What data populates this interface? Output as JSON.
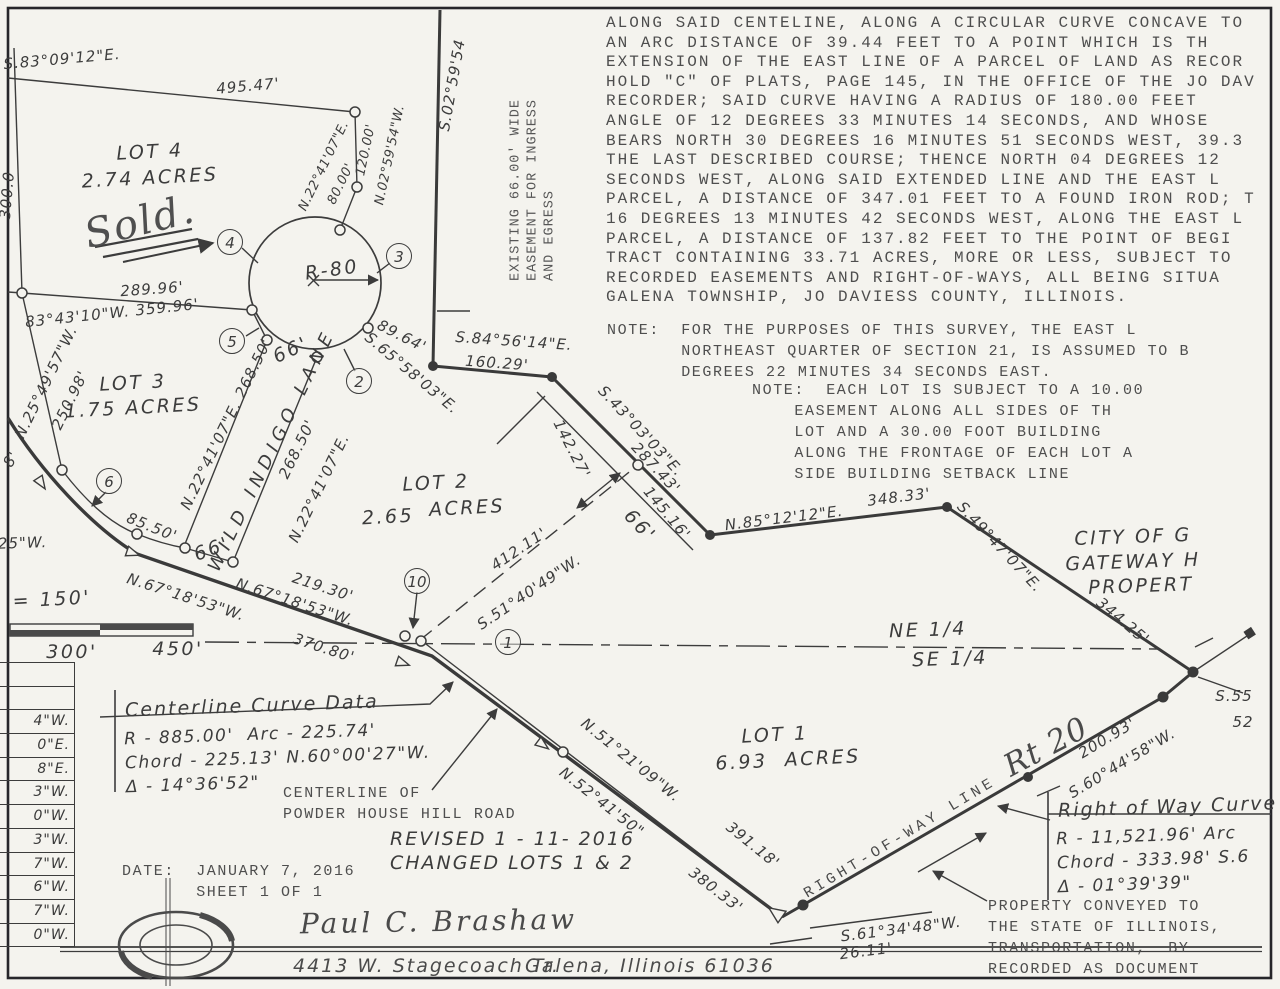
{
  "legal_description": "ALONG SAID CENTELINE, ALONG A CIRCULAR CURVE CONCAVE TO\nAN ARC DISTANCE OF 39.44 FEET TO A POINT WHICH IS TH\nEXTENSION OF THE EAST LINE OF A PARCEL OF LAND AS RECOR\nHOLD \"C\" OF PLATS, PAGE 145, IN THE OFFICE OF THE JO DAV\nRECORDER; SAID CURVE HAVING A RADIUS OF 180.00 FEET\nANGLE OF 12 DEGREES 33 MINUTES 14 SECONDS, AND WHOSE\nBEARS NORTH 30 DEGREES 16 MINUTES 51 SECONDS WEST, 39.3\nTHE LAST DESCRIBED COURSE; THENCE NORTH 04 DEGREES 12\nSECONDS WEST, ALONG SAID EXTENDED LINE AND THE EAST L\nPARCEL, A DISTANCE OF 347.01 FEET TO A FOUND IRON ROD; T\n16 DEGREES 13 MINUTES 42 SECONDS WEST, ALONG THE EAST L\nPARCEL, A DISTANCE OF 137.82 FEET TO THE POINT OF BEGI\nTRACT CONTAINING 33.71 ACRES, MORE OR LESS, SUBJECT TO\nRECORDED EASEMENTS AND RIGHT-OF-WAYS, ALL BEING SITUA\nGALENA TOWNSHIP, JO DAVIESS COUNTY, ILLINOIS.",
  "note_survey": "NOTE:  FOR THE PURPOSES OF THIS SURVEY, THE EAST L\n       NORTHEAST QUARTER OF SECTION 21, IS ASSUMED TO B\n       DEGREES 22 MINUTES 34 SECONDS EAST.",
  "note_lot": "NOTE:  EACH LOT IS SUBJECT TO A 10.00\n    EASEMENT ALONG ALL SIDES OF TH\n    LOT AND A 30.00 FOOT BUILDING\n    ALONG THE FRONTAGE OF EACH LOT A\n    SIDE BUILDING SETBACK LINE",
  "centerline_curve": {
    "title": "Centerline Curve Data",
    "body": "R - 885.00'  Arc - 225.74'\nChord - 225.13' N.60°00'27\"W.\nΔ - 14°36'52\""
  },
  "row_curve": {
    "title": "Right of Way Curve",
    "body": "R - 11,521.96' Arc\nChord - 333.98' S.6\nΔ - 01°39'39\""
  },
  "property_note": "PROPERTY CONVEYED TO\nTHE STATE OF ILLINOIS,\nTRANSPORTATION,  BY\nRECORDED AS DOCUMENT",
  "centerline_of": "CENTERLINE OF\nPOWDER HOUSE HILL ROAD",
  "revision": "REVISED 1 - 11- 2016\nCHANGED LOTS 1 & 2",
  "dateblock": "DATE:  JANUARY 7, 2016\n       SHEET 1 OF 1",
  "footer": {
    "name": "Paul C. Brashaw",
    "address": "4413 W. Stagecoach Tr.",
    "city": "Galena, Illinois  61036"
  },
  "side_table": [
    "",
    "",
    "4\"W.",
    "0\"E.",
    "8\"E.",
    "3\"W.",
    "0\"W.",
    "3\"W.",
    "7\"W.",
    "6\"W.",
    "7\"W.",
    "0\"W."
  ],
  "labels": [
    {
      "t": "S.83°09'12\"E.",
      "x": 62,
      "y": 59,
      "r": -5,
      "c": "hand"
    },
    {
      "t": "495.47'",
      "x": 248,
      "y": 86,
      "r": -5,
      "c": "hand"
    },
    {
      "t": "N.22°41'07\"E.",
      "x": 324,
      "y": 166,
      "r": -64,
      "c": "hand-s"
    },
    {
      "t": "80.00'",
      "x": 341,
      "y": 184,
      "r": -64,
      "c": "hand-s"
    },
    {
      "t": "120.00'",
      "x": 366,
      "y": 150,
      "r": -78,
      "c": "hand-s"
    },
    {
      "t": "N.02°59'54\"W.",
      "x": 390,
      "y": 155,
      "r": -78,
      "c": "hand-s"
    },
    {
      "t": "S.02°59'54",
      "x": 452,
      "y": 85,
      "r": -80,
      "c": "hand"
    },
    {
      "t": "300.0",
      "x": 7,
      "y": 195,
      "r": -85,
      "c": "hand"
    },
    {
      "t": "LOT 4",
      "x": 150,
      "y": 152,
      "r": -3,
      "c": "hand-big"
    },
    {
      "t": "2.74 ACRES",
      "x": 150,
      "y": 178,
      "r": -3,
      "c": "hand-big"
    },
    {
      "t": "Sold.",
      "x": 140,
      "y": 222,
      "r": -14,
      "c": "script-big"
    },
    {
      "t": "289.96'",
      "x": 152,
      "y": 289,
      "r": -4,
      "c": "hand"
    },
    {
      "t": "83°43'10\"W. 359.96'",
      "x": 112,
      "y": 313,
      "r": -6,
      "c": "hand"
    },
    {
      "t": "N.25°49'57\"W.",
      "x": 46,
      "y": 382,
      "r": -64,
      "c": "hand"
    },
    {
      "t": "250.98'",
      "x": 70,
      "y": 400,
      "r": -64,
      "c": "hand"
    },
    {
      "t": "8'",
      "x": 11,
      "y": 459,
      "r": -60,
      "c": "hand"
    },
    {
      "t": "LOT 3",
      "x": 133,
      "y": 383,
      "r": -3,
      "c": "hand-big"
    },
    {
      "t": "1.75 ACRES",
      "x": 133,
      "y": 408,
      "r": -3,
      "c": "hand-big"
    },
    {
      "t": "N.22°41'07\"E. 268.50'",
      "x": 226,
      "y": 424,
      "r": -64,
      "c": "hand"
    },
    {
      "t": "WILD INDIGO LANE",
      "x": 272,
      "y": 450,
      "r": -64,
      "c": "hand-sp"
    },
    {
      "t": "268.50'",
      "x": 297,
      "y": 449,
      "r": -64,
      "c": "hand"
    },
    {
      "t": "N.22°41'07\"E.",
      "x": 319,
      "y": 488,
      "r": -64,
      "c": "hand"
    },
    {
      "t": "66'",
      "x": 291,
      "y": 350,
      "r": -25,
      "c": "hand-big"
    },
    {
      "t": "66'",
      "x": 212,
      "y": 549,
      "r": -20,
      "c": "hand-big"
    },
    {
      "t": "85.50'",
      "x": 152,
      "y": 527,
      "r": 22,
      "c": "hand"
    },
    {
      "t": "'25\"W.",
      "x": 20,
      "y": 543,
      "r": -2,
      "c": "hand"
    },
    {
      "t": "89.64'",
      "x": 402,
      "y": 336,
      "r": 27,
      "c": "hand"
    },
    {
      "t": "S.65°58'03\"E.",
      "x": 412,
      "y": 373,
      "r": 40,
      "c": "hand"
    },
    {
      "t": "S.84°56'14\"E.",
      "x": 514,
      "y": 341,
      "r": 4,
      "c": "hand"
    },
    {
      "t": "160.29'",
      "x": 497,
      "y": 363,
      "r": 4,
      "c": "hand"
    },
    {
      "t": "142.27'",
      "x": 572,
      "y": 449,
      "r": 63,
      "c": "hand"
    },
    {
      "t": "S.43°03'03\"E.",
      "x": 641,
      "y": 431,
      "r": 47,
      "c": "hand"
    },
    {
      "t": "287.43'",
      "x": 656,
      "y": 468,
      "r": 47,
      "c": "hand"
    },
    {
      "t": "145.16'",
      "x": 667,
      "y": 513,
      "r": 50,
      "c": "hand"
    },
    {
      "t": "66'",
      "x": 640,
      "y": 526,
      "r": 47,
      "c": "hand-big"
    },
    {
      "t": "LOT 2",
      "x": 436,
      "y": 483,
      "r": -3,
      "c": "hand-big"
    },
    {
      "t": "2.65",
      "x": 388,
      "y": 517,
      "r": -3,
      "c": "hand-big"
    },
    {
      "t": "ACRES",
      "x": 467,
      "y": 508,
      "r": -3,
      "c": "hand-big"
    },
    {
      "t": "412.11'",
      "x": 519,
      "y": 549,
      "r": -34,
      "c": "hand"
    },
    {
      "t": "S.51°40'49\"W.",
      "x": 529,
      "y": 592,
      "r": -34,
      "c": "hand"
    },
    {
      "t": "N.85°12'12\"E.",
      "x": 784,
      "y": 518,
      "r": -7,
      "c": "hand"
    },
    {
      "t": "348.33'",
      "x": 899,
      "y": 497,
      "r": -7,
      "c": "hand"
    },
    {
      "t": "S.49°47'07\"E.",
      "x": 1000,
      "y": 547,
      "r": 47,
      "c": "hand"
    },
    {
      "t": "344.25'",
      "x": 1123,
      "y": 621,
      "r": 40,
      "c": "hand"
    },
    {
      "t": "CITY OF G",
      "x": 1133,
      "y": 537,
      "r": -2,
      "c": "hand-big"
    },
    {
      "t": "GATEWAY H",
      "x": 1133,
      "y": 562,
      "r": -2,
      "c": "hand-big"
    },
    {
      "t": "PROPERT",
      "x": 1141,
      "y": 586,
      "r": -2,
      "c": "hand-big"
    },
    {
      "t": "NE 1/4",
      "x": 928,
      "y": 630,
      "r": -2,
      "c": "hand-big"
    },
    {
      "t": "SE 1/4",
      "x": 950,
      "y": 659,
      "r": -2,
      "c": "hand-big"
    },
    {
      "t": "N.67°18'53\"W.",
      "x": 186,
      "y": 597,
      "r": 18,
      "c": "hand"
    },
    {
      "t": "370.80'",
      "x": 324,
      "y": 648,
      "r": 18,
      "c": "hand"
    },
    {
      "t": "N.67°18'53\"W.",
      "x": 295,
      "y": 602,
      "r": 18,
      "c": "hand"
    },
    {
      "t": "219.30'",
      "x": 323,
      "y": 587,
      "r": 18,
      "c": "hand"
    },
    {
      "t": "\" = 150'",
      "x": 42,
      "y": 600,
      "r": -3,
      "c": "hand-big"
    },
    {
      "t": "300'",
      "x": 72,
      "y": 652,
      "r": 0,
      "c": "hand-big"
    },
    {
      "t": "450'",
      "x": 178,
      "y": 649,
      "r": 0,
      "c": "hand-big"
    },
    {
      "t": "LOT 1",
      "x": 775,
      "y": 735,
      "r": -3,
      "c": "hand-big"
    },
    {
      "t": "6.93  ACRES",
      "x": 788,
      "y": 760,
      "r": -3,
      "c": "hand-big"
    },
    {
      "t": "N.51°21'09\"W.",
      "x": 631,
      "y": 760,
      "r": 39,
      "c": "hand"
    },
    {
      "t": "391.18'",
      "x": 753,
      "y": 845,
      "r": 39,
      "c": "hand"
    },
    {
      "t": "N.52°41'50\"",
      "x": 602,
      "y": 802,
      "r": 38,
      "c": "hand"
    },
    {
      "t": "380.33'",
      "x": 716,
      "y": 890,
      "r": 38,
      "c": "hand"
    },
    {
      "t": "RIGHT-OF-WAY LINE",
      "x": 900,
      "y": 838,
      "r": -31,
      "c": "typed-sp"
    },
    {
      "t": "Rt 20",
      "x": 1046,
      "y": 747,
      "r": -28,
      "c": "script-big2"
    },
    {
      "t": "200.93'",
      "x": 1107,
      "y": 738,
      "r": -31,
      "c": "hand"
    },
    {
      "t": "S.60°44'58\"W.",
      "x": 1122,
      "y": 763,
      "r": -31,
      "c": "hand"
    },
    {
      "t": "S.55",
      "x": 1234,
      "y": 696,
      "r": 0,
      "c": "hand"
    },
    {
      "t": "52",
      "x": 1243,
      "y": 722,
      "r": 0,
      "c": "hand"
    },
    {
      "t": "S.61°34'48\"W.",
      "x": 901,
      "y": 929,
      "r": -7,
      "c": "hand"
    },
    {
      "t": "26.11'",
      "x": 866,
      "y": 951,
      "r": -7,
      "c": "hand"
    },
    {
      "t": "R-80",
      "x": 332,
      "y": 270,
      "r": -8,
      "c": "hand-big"
    },
    {
      "t": "EXISTING 66.00' WIDE\nEASEMENT FOR INGRESS\nAND EGRESS",
      "x": 533,
      "y": 190,
      "r": -90,
      "c": "typed-v"
    },
    {
      "t": "4",
      "x": 230,
      "y": 242,
      "r": 0,
      "c": "circ"
    },
    {
      "t": "3",
      "x": 399,
      "y": 256,
      "r": 0,
      "c": "circ"
    },
    {
      "t": "5",
      "x": 232,
      "y": 341,
      "r": 0,
      "c": "circ"
    },
    {
      "t": "2",
      "x": 359,
      "y": 381,
      "r": 0,
      "c": "circ"
    },
    {
      "t": "6",
      "x": 109,
      "y": 481,
      "r": 0,
      "c": "circ"
    },
    {
      "t": "10",
      "x": 417,
      "y": 581,
      "r": 0,
      "c": "circ"
    },
    {
      "t": "1",
      "x": 508,
      "y": 642,
      "r": 0,
      "c": "circ"
    }
  ]
}
